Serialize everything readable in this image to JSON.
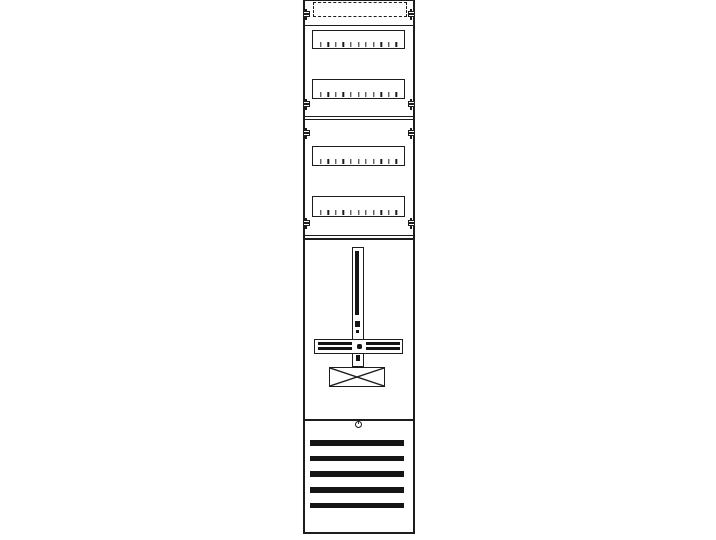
{
  "figure": {
    "kind": "technical-line-drawing",
    "subject": "single-field meter distribution panel, front view",
    "colors": {
      "background": "#ffffff",
      "line": "#1d1d1d",
      "fill": "#151515"
    },
    "top_section": {
      "dashed_cutout": true,
      "module_rows": 2
    },
    "middle_section": {
      "module_rows": 2
    },
    "module_row_tick_count": 11,
    "fixing_screw_rows_y": [
      14,
      104,
      133,
      223
    ],
    "meter_section": {
      "mounting_cross": true,
      "terminal_block_x_box": true,
      "lower_cross_dot": true
    },
    "bottom_section": {
      "vent_slat_count": 5,
      "lock_circle": true
    }
  }
}
